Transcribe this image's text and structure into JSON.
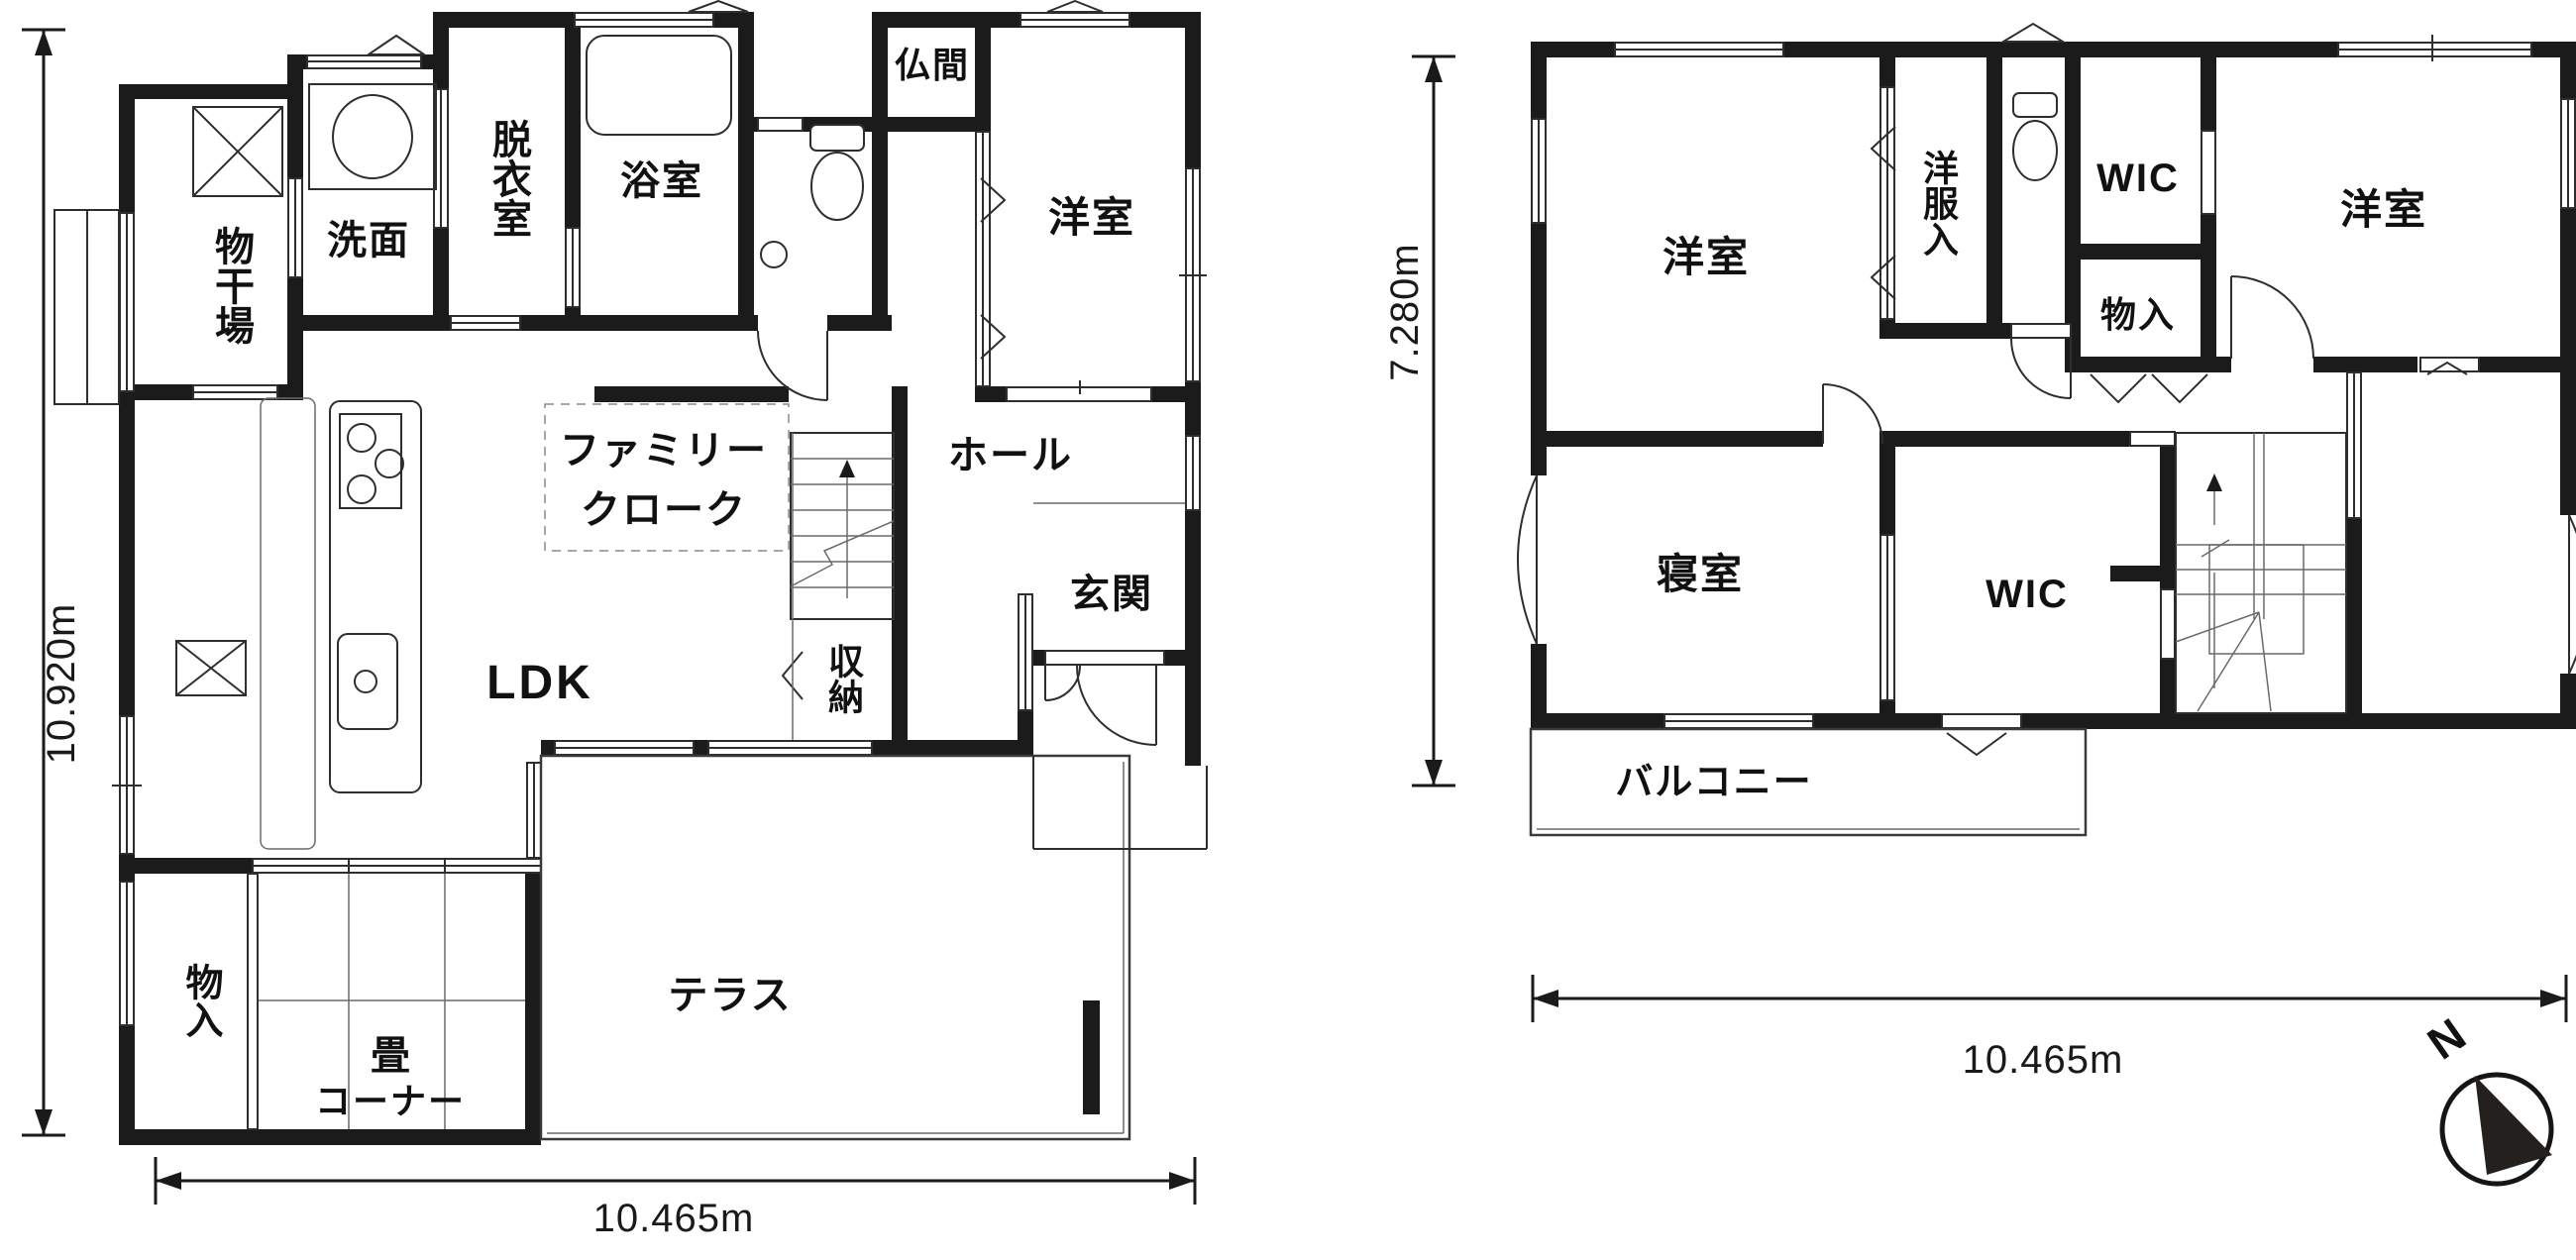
{
  "colors": {
    "background": "#ffffff",
    "wall": "#1b1b1b",
    "line": "#2e2e2e",
    "text": "#111111"
  },
  "floor1": {
    "rooms": {
      "monohoshiba": "物干場",
      "senmen": "洗面",
      "datsuishitsu": "脱衣室",
      "yokushitsu": "浴室",
      "butsuma": "仏間",
      "youshitsu": "洋室",
      "family_cloak_line1": "ファミリー",
      "family_cloak_line2": "クローク",
      "hall": "ホール",
      "ldk": "LDK",
      "shuunou": "収納",
      "genkan": "玄関",
      "monoire": "物入",
      "tatami_line1": "畳",
      "tatami_line2": "コーナー",
      "terrace": "テラス"
    },
    "dimensions": {
      "height": "10.920m",
      "width": "10.465m"
    }
  },
  "floor2": {
    "rooms": {
      "youshitsu_left": "洋室",
      "youfukuire": "洋服入",
      "wic_top": "WIC",
      "youshitsu_right": "洋室",
      "monoire": "物入",
      "shinshitsu": "寝室",
      "wic_center": "WIC",
      "balcony": "バルコニー"
    },
    "dimensions": {
      "height": "7.280m",
      "width": "10.465m"
    }
  },
  "compass": {
    "north": "N"
  }
}
